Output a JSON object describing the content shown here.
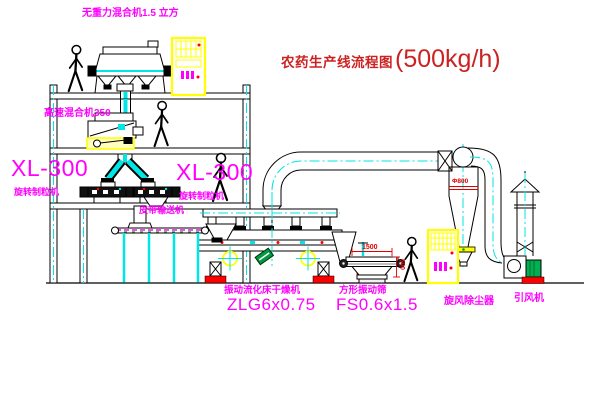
{
  "title": {
    "name": "农药生产线流程图",
    "capacity": "(500kg/h)"
  },
  "equipment": {
    "gravity_mixer": {
      "label": "无重力混合机1.5 立方"
    },
    "high_speed_mixer": {
      "label": "高速混合机350"
    },
    "granulator_left": {
      "model": "XL-300",
      "name": "旋转制粒机"
    },
    "granulator_right": {
      "model": "XL-300",
      "name": "旋转制粒机"
    },
    "belt_conveyor": {
      "label": "皮带输送机"
    },
    "dryer": {
      "name": "振动流化床干燥机",
      "model": "ZLG6x0.75"
    },
    "screen": {
      "name": "方形振动筛",
      "model": "FS0.6x1.5",
      "dim_width_mm": "1500",
      "dim_height_mm": "500"
    },
    "cyclone": {
      "label": "旋风除尘器",
      "dim": "Φ800"
    },
    "fan": {
      "label": "引风机"
    }
  },
  "colors": {
    "label_magenta": "#FF00FF",
    "title_red": "#CC2222",
    "dimension_red": "#E00000",
    "line_black": "#000000",
    "pipe_cyan": "#00E5E5",
    "cabinet_yellow": "#FFFF00",
    "motor_green": "#00B050",
    "base_red": "#FF0000"
  }
}
